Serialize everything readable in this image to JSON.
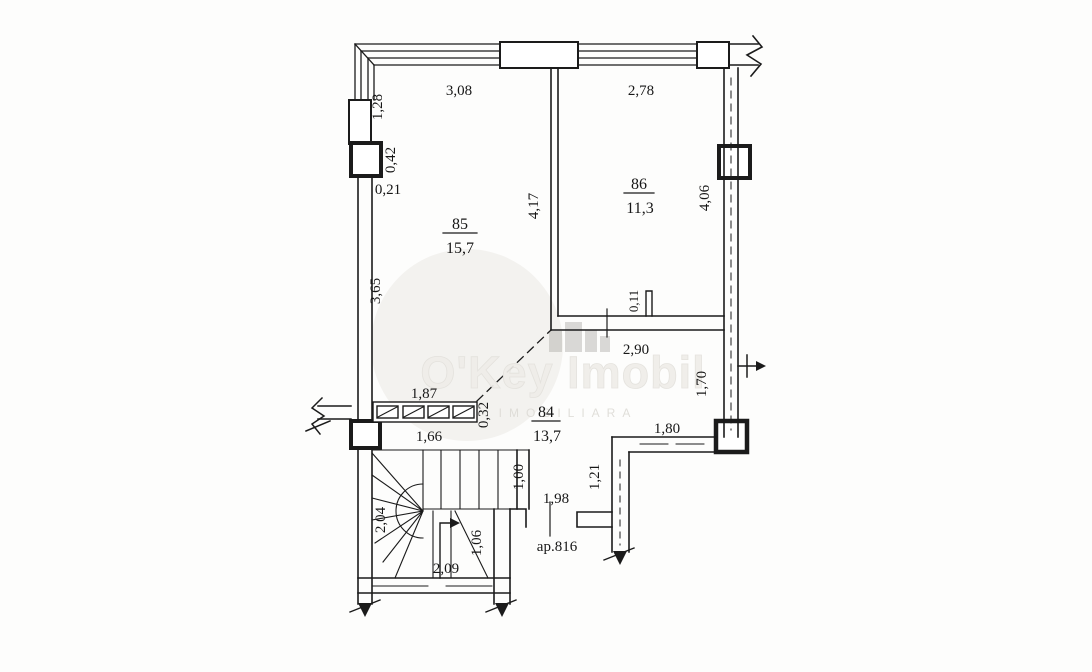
{
  "plan": {
    "apartment_label": "ap.816",
    "rooms": [
      {
        "number": "85",
        "area": "15,7"
      },
      {
        "number": "86",
        "area": "11,3"
      },
      {
        "number": "84",
        "area": "13,7"
      }
    ],
    "dimensions": {
      "d308": "3,08",
      "d278": "2,78",
      "d128": "1,28",
      "d042": "0,42",
      "d021": "0,21",
      "d417": "4,17",
      "d406": "4,06",
      "d365": "3,65",
      "d011": "0,11",
      "d290": "2,90",
      "d187": "1,87",
      "d170": "1,70",
      "d032": "0,32",
      "d166": "1,66",
      "d180": "1,80",
      "d100": "1,00",
      "d121": "1,21",
      "d204": "2,04",
      "d198": "1,98",
      "d106": "1,06",
      "d209": "2,09"
    }
  },
  "watermark": {
    "brand": "O'Key Imobil",
    "tagline": "IMOBILIARA"
  },
  "colors": {
    "ink": "#1b1b1b",
    "watermark_circle": "#f3f2ef"
  }
}
